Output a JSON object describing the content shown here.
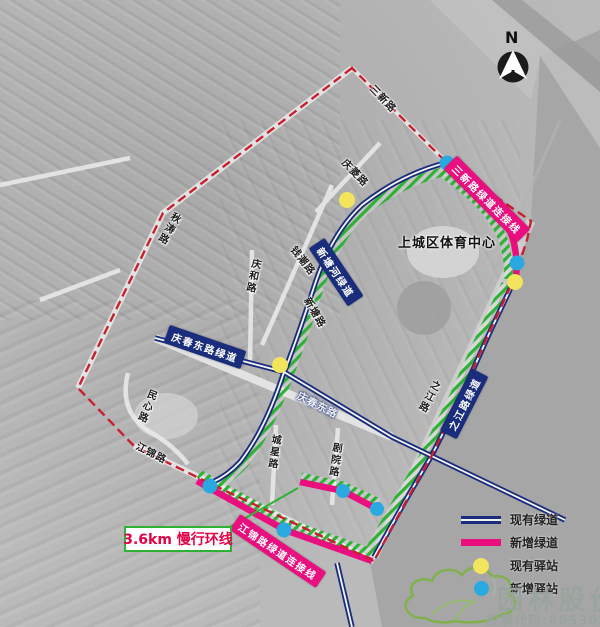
{
  "map": {
    "north": "N",
    "poi": {
      "sports_center": "上城区体育中心"
    },
    "roads": {
      "sanxin": "三新路",
      "qingling": "庆菱路",
      "qiutao": "秋涛路",
      "qinghe": "庆和路",
      "qianchao": "钱潮路",
      "xintang": "新塘路",
      "qingchun_east": "庆春东路",
      "zhijiang": "之江路",
      "minxin": "民心路",
      "jiangjin": "江锦路",
      "chengxing": "城星路",
      "juyuan": "剧院路"
    },
    "greenway_tags": {
      "xintang_river": "新塘河绿道",
      "qingchun_east": "庆春东路绿道",
      "zhijiang": "之江路绿道",
      "sanxin_connect": "三新路绿道连接线",
      "jiangjin_connect": "江锦路绿道连接线"
    },
    "callout": {
      "loop_label": "3.6km 慢行环线"
    }
  },
  "legend": {
    "items": [
      {
        "label": "现有绿道",
        "key": "existing-greenway"
      },
      {
        "label": "新增绿道",
        "key": "new-greenway"
      },
      {
        "label": "现有驿站",
        "key": "existing-station"
      },
      {
        "label": "新增驿站",
        "key": "new-station"
      }
    ]
  },
  "logo": {
    "company": "园林股份",
    "stock": "股票代码:605303"
  },
  "colors": {
    "existing_greenway": "#1a2d7c",
    "new_greenway": "#ea0f7e",
    "loop_green": "#2eb135",
    "existing_station": "#f2e45c",
    "new_station": "#2aa9e1",
    "boundary_red": "#c8202f"
  }
}
